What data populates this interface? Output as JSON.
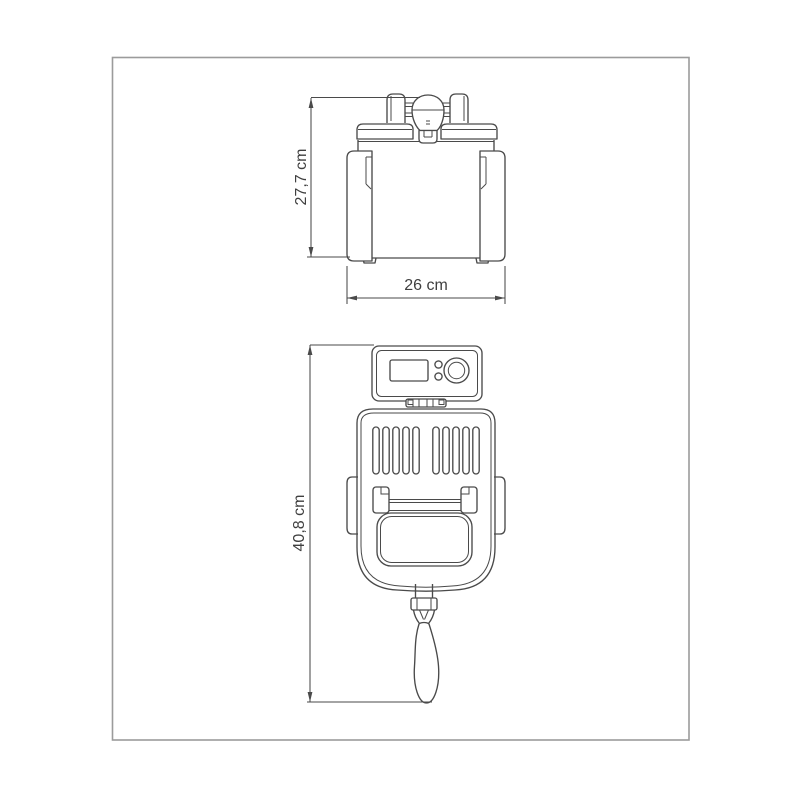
{
  "document": {
    "type": "product-dimension-drawing",
    "views": {
      "front": {
        "height": {
          "value": "27,7 cm"
        },
        "width": {
          "value": "26 cm"
        }
      },
      "top": {
        "length": {
          "value": "40,8 cm"
        }
      }
    },
    "colors": {
      "background": "#ffffff",
      "border": "#9b9b9b",
      "line": "#4a4a4a",
      "text": "#3f3f3f"
    }
  }
}
